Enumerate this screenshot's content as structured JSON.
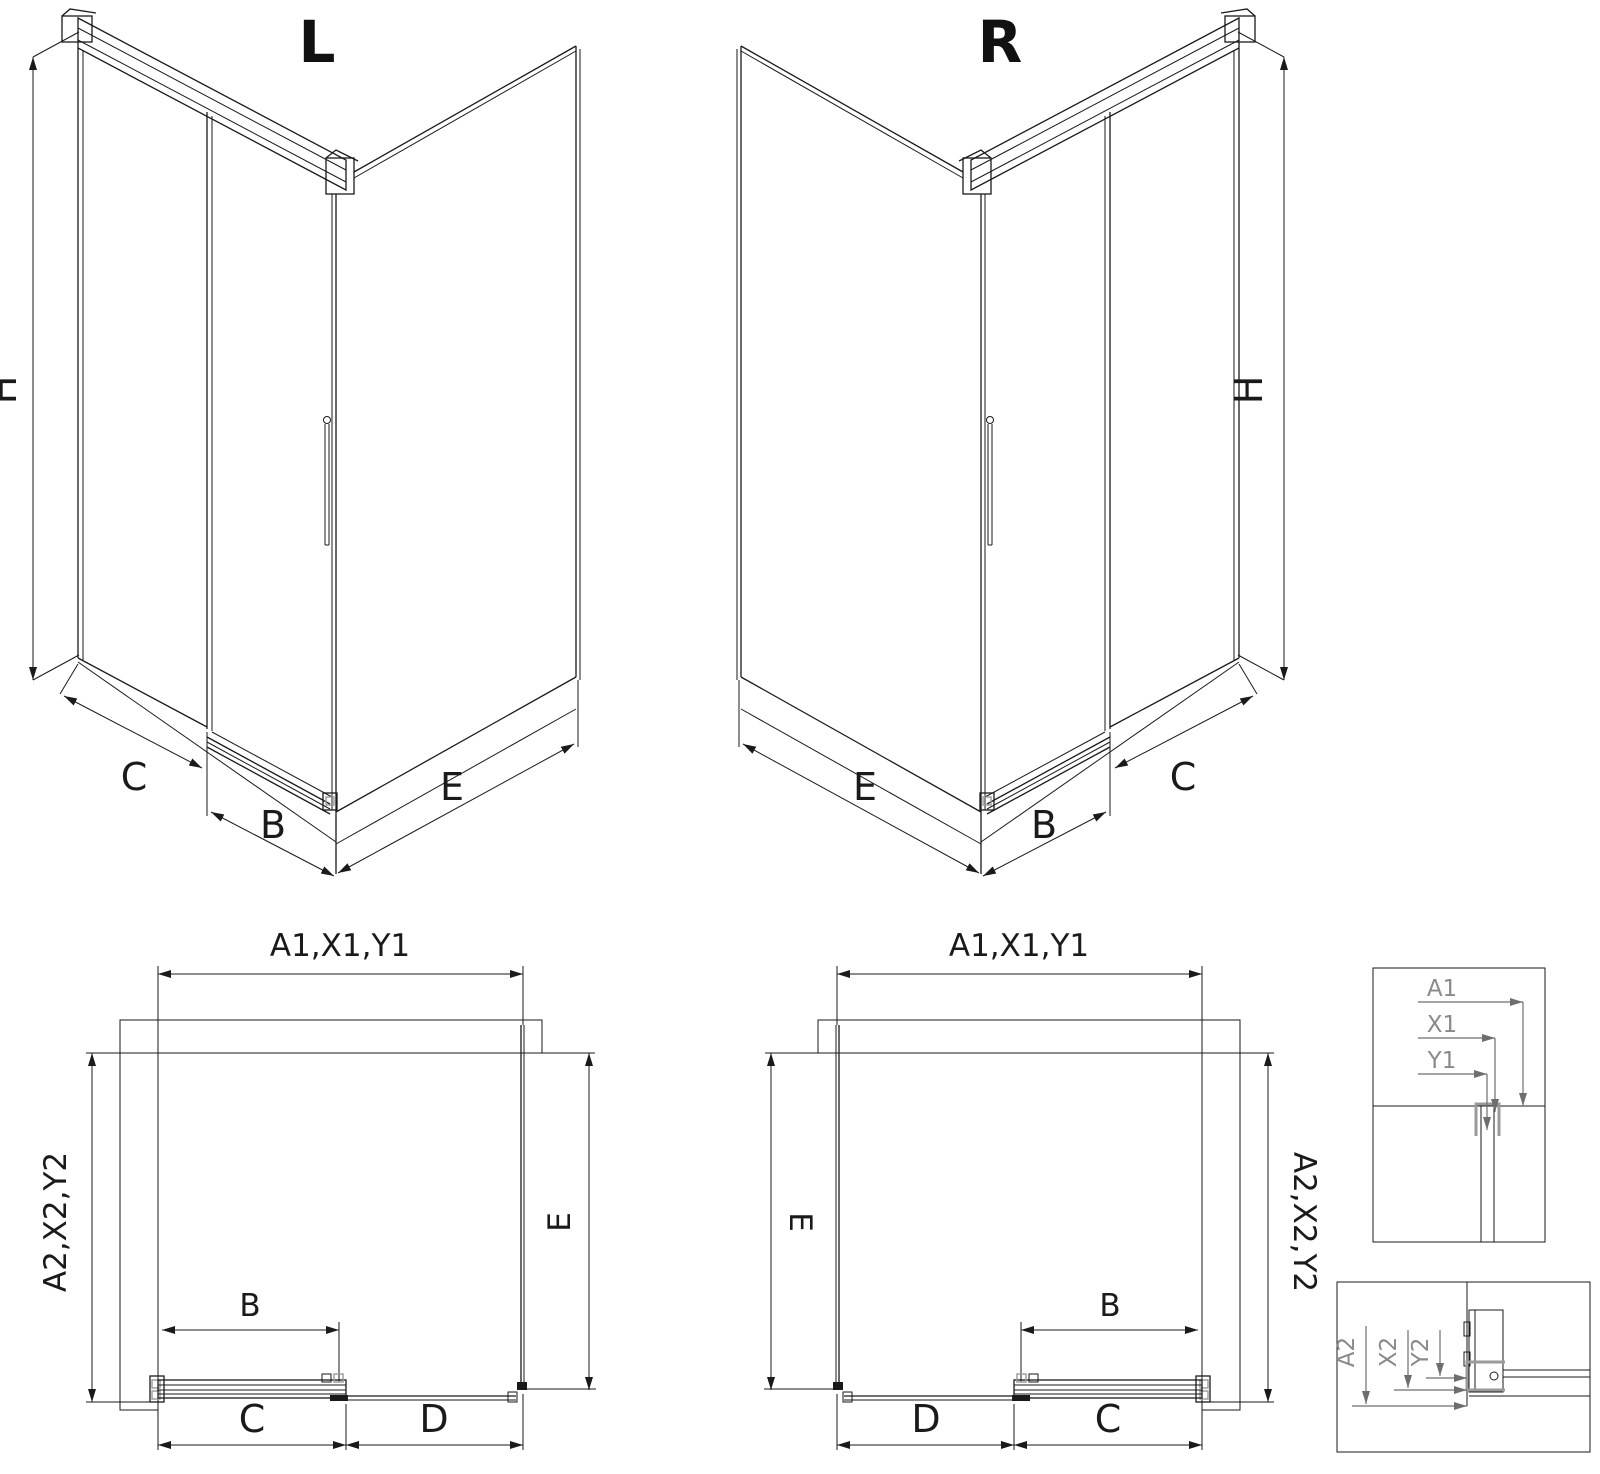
{
  "colors": {
    "line": "#1a1a1a",
    "profile_gray": "#9a9a9a",
    "detail_text_gray": "#8a8a8a",
    "background": "#ffffff"
  },
  "iso_left": {
    "title": "L",
    "dim_height": "H",
    "dim_fixed_panel": "C",
    "dim_sliding_door": "B",
    "dim_side_panel": "E"
  },
  "iso_right": {
    "title": "R",
    "dim_height": "H",
    "dim_side_panel": "E",
    "dim_sliding_door": "B",
    "dim_fixed_panel": "C"
  },
  "plan_left": {
    "dim_width_top": "A1,X1,Y1",
    "dim_depth_left": "A2,X2,Y2",
    "dim_side_right": "E",
    "dim_door_opening": "B",
    "dim_bottom_inner": "C",
    "dim_bottom_outer": "D"
  },
  "plan_right": {
    "dim_width_top": "A1,X1,Y1",
    "dim_depth_right": "A2,X2,Y2",
    "dim_side_left": "E",
    "dim_door_opening": "B",
    "dim_bottom_outer": "D",
    "dim_bottom_inner": "C"
  },
  "detail_top": {
    "labels": [
      "A1",
      "X1",
      "Y1"
    ]
  },
  "detail_bottom": {
    "labels": [
      "A2",
      "X2",
      "Y2"
    ]
  }
}
